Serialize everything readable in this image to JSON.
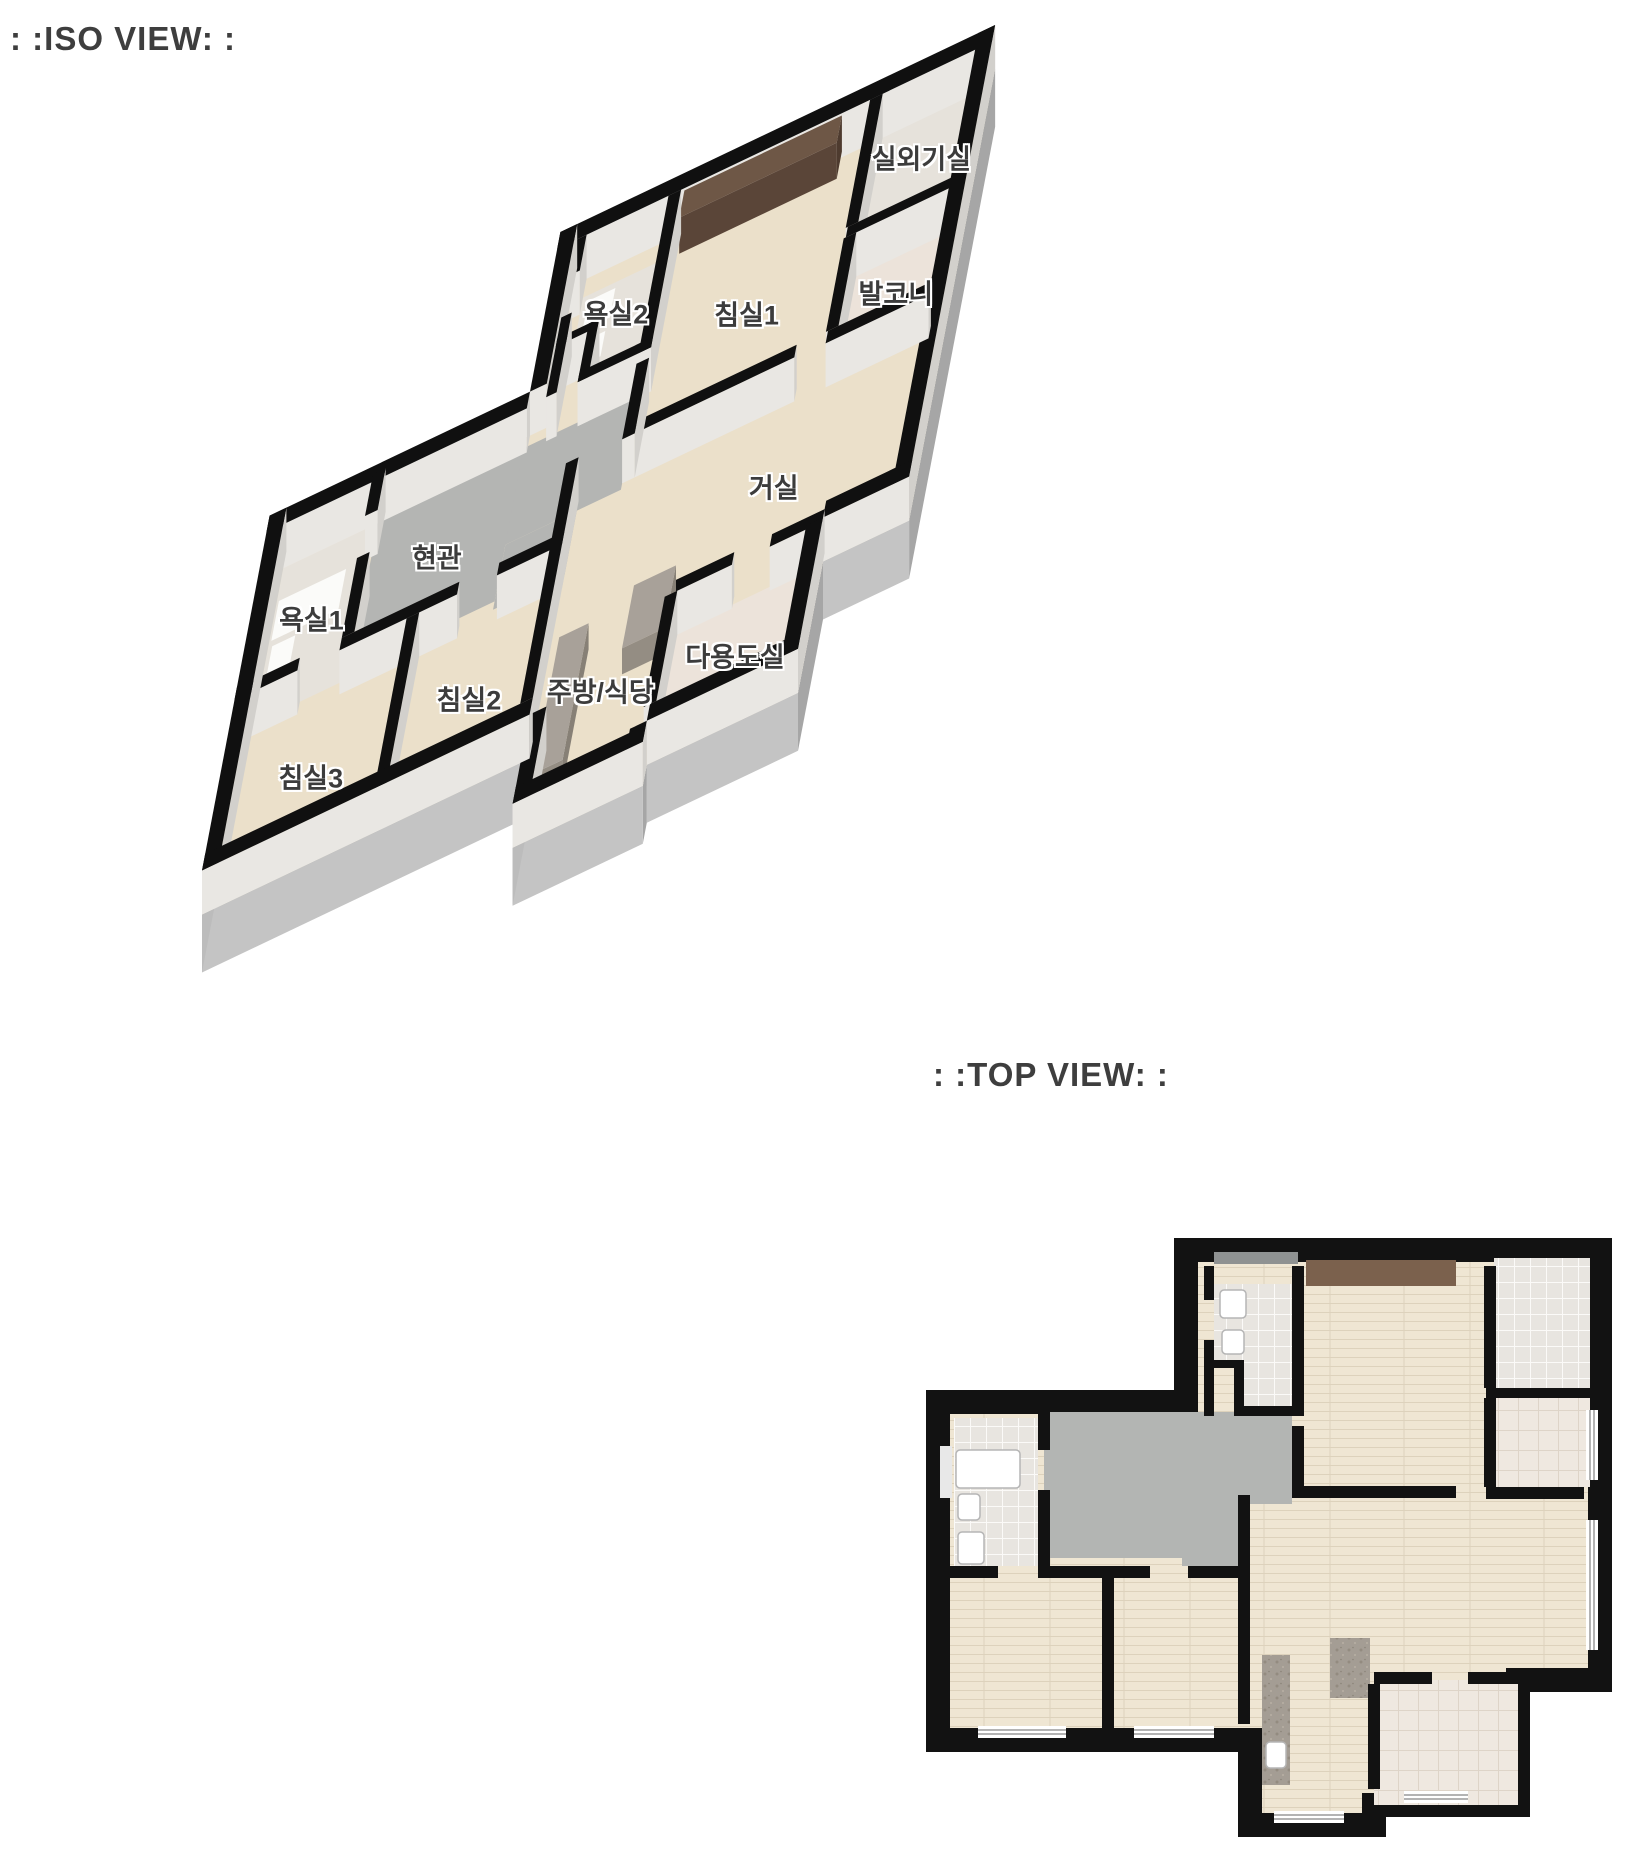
{
  "iso_view": {
    "title": ": :ISO VIEW: :",
    "labels": [
      {
        "id": "outdoor-unit-room",
        "text": "실외기실"
      },
      {
        "id": "balcony",
        "text": "발코니"
      },
      {
        "id": "bedroom-1",
        "text": "침실1"
      },
      {
        "id": "bathroom-2",
        "text": "욕실2"
      },
      {
        "id": "living-room",
        "text": "거실"
      },
      {
        "id": "kitchen-dining",
        "text": "주방/식당"
      },
      {
        "id": "utility-room",
        "text": "다용도실"
      },
      {
        "id": "entrance",
        "text": "현관"
      },
      {
        "id": "bathroom-1",
        "text": "욕실1"
      },
      {
        "id": "bedroom-2",
        "text": "침실2"
      },
      {
        "id": "bedroom-3",
        "text": "침실3"
      }
    ]
  },
  "top_view": {
    "title": ": :TOP VIEW: :"
  },
  "colors": {
    "wall": "#111111",
    "wall_side_light": "#e9e7e3",
    "wall_side_dark": "#d2d0cc",
    "slab_gray": "#b5b5b5",
    "floor_wood": "#efe6d3",
    "floor_tile": "#e8e5e0",
    "floor_balcony_tile": "#efe8e0",
    "floor_gray": "#b3b5b3",
    "granite": "#a49d94",
    "closet_brown": "#7b614d",
    "title_text": "#3e3e3e",
    "label_text": "#3c3c3c"
  }
}
